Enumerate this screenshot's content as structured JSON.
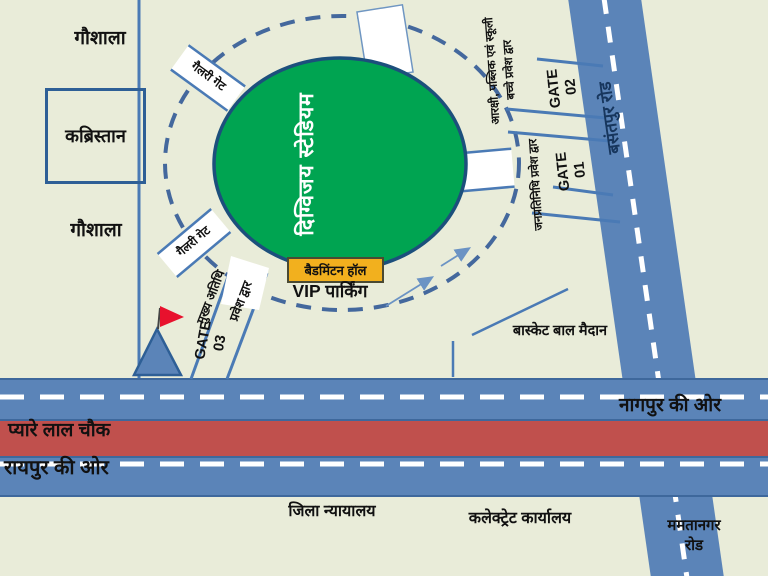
{
  "title": "दिग्विजय स्टेडियम मार्ग मानचित्र",
  "colors": {
    "background": "#e9ecd9",
    "road_blue": "#5b84b8",
    "median_red": "#c0504d",
    "stadium_green": "#00a451",
    "line_blue": "#4a7ab5",
    "road_label_navy": "#17365d",
    "badminton_yellow": "#f2b01e",
    "flag_red": "#e8112d",
    "dash_white": "#ffffff"
  },
  "stadium": {
    "label": "दिग्विजय स्टेडियम"
  },
  "landmarks": {
    "gaushala_top": "गौशाला",
    "kabristan": "कब्रिस्तान",
    "gaushala_bottom": "गौशाला",
    "badminton_hall": "बैडमिंटन हॉल",
    "vip_parking": "VIP पार्किंग",
    "basketball_ground": "बास्केट बाल मैदान",
    "district_court": "जिला न्यायालय",
    "collectorate_office": "कलेक्ट्रेट कार्यालय",
    "pyare_lal_chowk": "प्यारे लाल चौक"
  },
  "roads": {
    "basantpur": "बसंतपुर रोड",
    "mamtanagar": "ममतानगर\nरोड",
    "towards_nagpur": "नागपुर की ओर",
    "towards_raipur": "रायपुर की ओर"
  },
  "gates": {
    "gate01": "GATE\n01",
    "gate02": "GATE\n02",
    "gate03": "GATE\n03",
    "gallery_gate_upper": "गैलरी गेट",
    "gallery_gate_lower": "गैलरी गेट",
    "chief_guest_line1": "मुख्य अतिथि",
    "chief_guest_line2": "प्रवेश द्वार",
    "public_school_entry": "आरक्षी, पब्लिक एवं स्कूली\nबच्चे प्रवेश द्वार",
    "representatives_entry": "जनप्रतिनिधि प्रवेश द्वार"
  }
}
